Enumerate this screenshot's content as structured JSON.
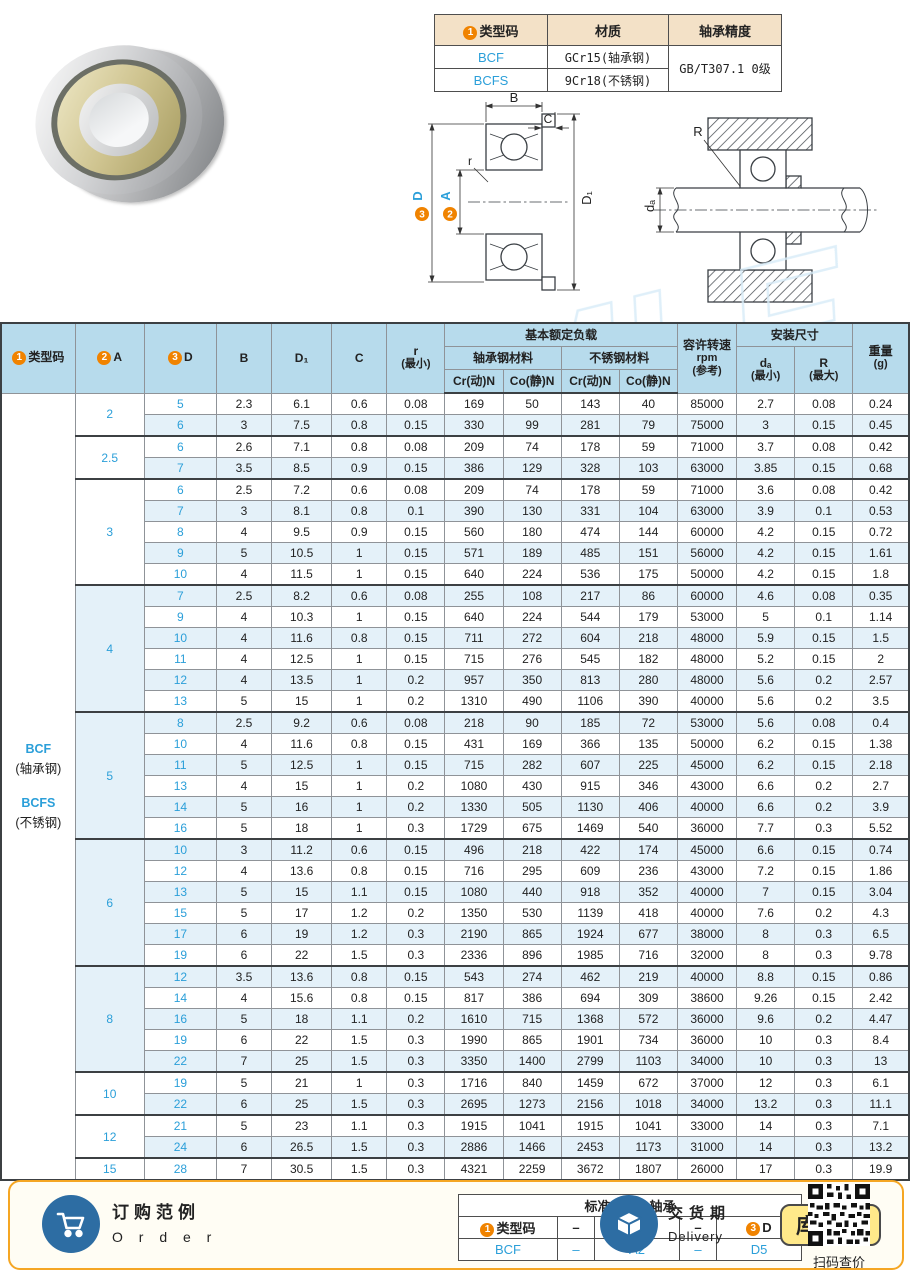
{
  "watermark": "SAMLE",
  "spec_table": {
    "h_type_badge": "1",
    "h_type": "类型码",
    "h_material": "材质",
    "h_precision": "轴承精度",
    "rows": [
      {
        "code": "BCF",
        "material": "GCr15(轴承钢)"
      },
      {
        "code": "BCFS",
        "material": "9Cr18(不锈钢)"
      }
    ],
    "precision": "GB/T307.1 0级"
  },
  "diagram": {
    "b": "B",
    "c": "C",
    "r": "r",
    "a_badge": "2",
    "a": "A",
    "d_badge": "3",
    "d": "D",
    "d1": "D₁",
    "r_right": "R",
    "da": "dₐ"
  },
  "table": {
    "header": {
      "col_type_badge": "1",
      "col_type": "类型码",
      "col_a_badge": "2",
      "col_a": "A",
      "col_d_badge": "3",
      "col_d": "D",
      "col_b": "B",
      "col_d1": "D₁",
      "col_c": "C",
      "col_r": "r",
      "col_r_sub": "(最小)",
      "load_group": "基本额定负载",
      "steel_group": "轴承钢材料",
      "stainless_group": "不锈钢材料",
      "cr_dyn": "Cr(动)N",
      "co_stat": "Co(静)N",
      "speed_1": "容许转速",
      "speed_2": "rpm",
      "speed_3": "(参考)",
      "install_group": "安装尺寸",
      "da_1": "dₐ",
      "da_2": "(最小)",
      "rmax_1": "R",
      "rmax_2": "(最大)",
      "weight_1": "重量",
      "weight_2": "(g)"
    },
    "type_column": [
      "BCF",
      "(轴承钢)",
      "BCFS",
      "(不锈钢)"
    ],
    "groups": [
      {
        "a": "2",
        "rows": [
          [
            "5",
            "2.3",
            "6.1",
            "0.6",
            "0.08",
            "169",
            "50",
            "143",
            "40",
            "85000",
            "2.7",
            "0.08",
            "0.24"
          ],
          [
            "6",
            "3",
            "7.5",
            "0.8",
            "0.15",
            "330",
            "99",
            "281",
            "79",
            "75000",
            "3",
            "0.15",
            "0.45"
          ]
        ]
      },
      {
        "a": "2.5",
        "rows": [
          [
            "6",
            "2.6",
            "7.1",
            "0.8",
            "0.08",
            "209",
            "74",
            "178",
            "59",
            "71000",
            "3.7",
            "0.08",
            "0.42"
          ],
          [
            "7",
            "3.5",
            "8.5",
            "0.9",
            "0.15",
            "386",
            "129",
            "328",
            "103",
            "63000",
            "3.85",
            "0.15",
            "0.68"
          ]
        ]
      },
      {
        "a": "3",
        "rows": [
          [
            "6",
            "2.5",
            "7.2",
            "0.6",
            "0.08",
            "209",
            "74",
            "178",
            "59",
            "71000",
            "3.6",
            "0.08",
            "0.42"
          ],
          [
            "7",
            "3",
            "8.1",
            "0.8",
            "0.1",
            "390",
            "130",
            "331",
            "104",
            "63000",
            "3.9",
            "0.1",
            "0.53"
          ],
          [
            "8",
            "4",
            "9.5",
            "0.9",
            "0.15",
            "560",
            "180",
            "474",
            "144",
            "60000",
            "4.2",
            "0.15",
            "0.72"
          ],
          [
            "9",
            "5",
            "10.5",
            "1",
            "0.15",
            "571",
            "189",
            "485",
            "151",
            "56000",
            "4.2",
            "0.15",
            "1.61"
          ],
          [
            "10",
            "4",
            "11.5",
            "1",
            "0.15",
            "640",
            "224",
            "536",
            "175",
            "50000",
            "4.2",
            "0.15",
            "1.8"
          ]
        ]
      },
      {
        "a": "4",
        "rows": [
          [
            "7",
            "2.5",
            "8.2",
            "0.6",
            "0.08",
            "255",
            "108",
            "217",
            "86",
            "60000",
            "4.6",
            "0.08",
            "0.35"
          ],
          [
            "9",
            "4",
            "10.3",
            "1",
            "0.15",
            "640",
            "224",
            "544",
            "179",
            "53000",
            "5",
            "0.1",
            "1.14"
          ],
          [
            "10",
            "4",
            "11.6",
            "0.8",
            "0.15",
            "711",
            "272",
            "604",
            "218",
            "48000",
            "5.9",
            "0.15",
            "1.5"
          ],
          [
            "11",
            "4",
            "12.5",
            "1",
            "0.15",
            "715",
            "276",
            "545",
            "182",
            "48000",
            "5.2",
            "0.15",
            "2"
          ],
          [
            "12",
            "4",
            "13.5",
            "1",
            "0.2",
            "957",
            "350",
            "813",
            "280",
            "48000",
            "5.6",
            "0.2",
            "2.57"
          ],
          [
            "13",
            "5",
            "15",
            "1",
            "0.2",
            "1310",
            "490",
            "1106",
            "390",
            "40000",
            "5.6",
            "0.2",
            "3.5"
          ]
        ]
      },
      {
        "a": "5",
        "rows": [
          [
            "8",
            "2.5",
            "9.2",
            "0.6",
            "0.08",
            "218",
            "90",
            "185",
            "72",
            "53000",
            "5.6",
            "0.08",
            "0.4"
          ],
          [
            "10",
            "4",
            "11.6",
            "0.8",
            "0.15",
            "431",
            "169",
            "366",
            "135",
            "50000",
            "6.2",
            "0.15",
            "1.38"
          ],
          [
            "11",
            "5",
            "12.5",
            "1",
            "0.15",
            "715",
            "282",
            "607",
            "225",
            "45000",
            "6.2",
            "0.15",
            "2.18"
          ],
          [
            "13",
            "4",
            "15",
            "1",
            "0.2",
            "1080",
            "430",
            "915",
            "346",
            "43000",
            "6.6",
            "0.2",
            "2.7"
          ],
          [
            "14",
            "5",
            "16",
            "1",
            "0.2",
            "1330",
            "505",
            "1130",
            "406",
            "40000",
            "6.6",
            "0.2",
            "3.9"
          ],
          [
            "16",
            "5",
            "18",
            "1",
            "0.3",
            "1729",
            "675",
            "1469",
            "540",
            "36000",
            "7.7",
            "0.3",
            "5.52"
          ]
        ]
      },
      {
        "a": "6",
        "rows": [
          [
            "10",
            "3",
            "11.2",
            "0.6",
            "0.15",
            "496",
            "218",
            "422",
            "174",
            "45000",
            "6.6",
            "0.15",
            "0.74"
          ],
          [
            "12",
            "4",
            "13.6",
            "0.8",
            "0.15",
            "716",
            "295",
            "609",
            "236",
            "43000",
            "7.2",
            "0.15",
            "1.86"
          ],
          [
            "13",
            "5",
            "15",
            "1.1",
            "0.15",
            "1080",
            "440",
            "918",
            "352",
            "40000",
            "7",
            "0.15",
            "3.04"
          ],
          [
            "15",
            "5",
            "17",
            "1.2",
            "0.2",
            "1350",
            "530",
            "1139",
            "418",
            "40000",
            "7.6",
            "0.2",
            "4.3"
          ],
          [
            "17",
            "6",
            "19",
            "1.2",
            "0.3",
            "2190",
            "865",
            "1924",
            "677",
            "38000",
            "8",
            "0.3",
            "6.5"
          ],
          [
            "19",
            "6",
            "22",
            "1.5",
            "0.3",
            "2336",
            "896",
            "1985",
            "716",
            "32000",
            "8",
            "0.3",
            "9.78"
          ]
        ]
      },
      {
        "a": "8",
        "rows": [
          [
            "12",
            "3.5",
            "13.6",
            "0.8",
            "0.15",
            "543",
            "274",
            "462",
            "219",
            "40000",
            "8.8",
            "0.15",
            "0.86"
          ],
          [
            "14",
            "4",
            "15.6",
            "0.8",
            "0.15",
            "817",
            "386",
            "694",
            "309",
            "38600",
            "9.26",
            "0.15",
            "2.42"
          ],
          [
            "16",
            "5",
            "18",
            "1.1",
            "0.2",
            "1610",
            "715",
            "1368",
            "572",
            "36000",
            "9.6",
            "0.2",
            "4.47"
          ],
          [
            "19",
            "6",
            "22",
            "1.5",
            "0.3",
            "1990",
            "865",
            "1901",
            "734",
            "36000",
            "10",
            "0.3",
            "8.4"
          ],
          [
            "22",
            "7",
            "25",
            "1.5",
            "0.3",
            "3350",
            "1400",
            "2799",
            "1103",
            "34000",
            "10",
            "0.3",
            "13"
          ]
        ]
      },
      {
        "a": "10",
        "rows": [
          [
            "19",
            "5",
            "21",
            "1",
            "0.3",
            "1716",
            "840",
            "1459",
            "672",
            "37000",
            "12",
            "0.3",
            "6.1"
          ],
          [
            "22",
            "6",
            "25",
            "1.5",
            "0.3",
            "2695",
            "1273",
            "2156",
            "1018",
            "34000",
            "13.2",
            "0.3",
            "11.1"
          ]
        ]
      },
      {
        "a": "12",
        "rows": [
          [
            "21",
            "5",
            "23",
            "1.1",
            "0.3",
            "1915",
            "1041",
            "1915",
            "1041",
            "33000",
            "14",
            "0.3",
            "7.1"
          ],
          [
            "24",
            "6",
            "26.5",
            "1.5",
            "0.3",
            "2886",
            "1466",
            "2453",
            "1173",
            "31000",
            "14",
            "0.3",
            "13.2"
          ]
        ]
      },
      {
        "a": "15",
        "rows": [
          [
            "28",
            "7",
            "30.5",
            "1.5",
            "0.3",
            "4321",
            "2259",
            "3672",
            "1807",
            "26000",
            "17",
            "0.3",
            "19.9"
          ]
        ]
      }
    ]
  },
  "footer": {
    "order": {
      "line1": "订购范例",
      "line2": "O r d e r",
      "table": {
        "title": "标准品名：轴承",
        "h1_badge": "1",
        "h1": "类型码",
        "h2_badge": "2",
        "h2": "A",
        "h3_badge": "3",
        "h3": "D",
        "dash": "–",
        "v1": "BCF",
        "v2": "A2",
        "v3": "D5"
      }
    },
    "delivery": {
      "line1": "交货期",
      "line2": "Delivery",
      "stock_badge": "库存品",
      "qr_caption": "扫码查价"
    }
  }
}
